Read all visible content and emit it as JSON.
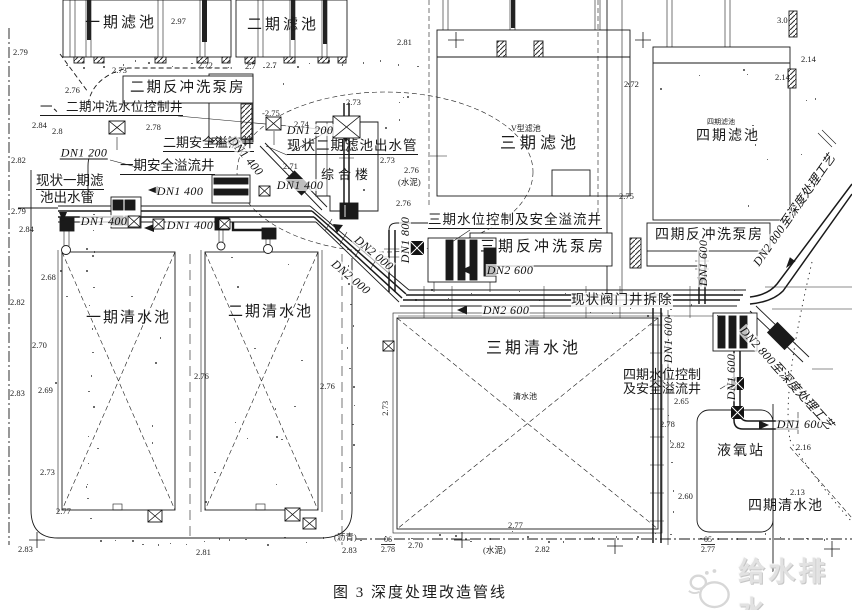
{
  "title_caption": "图 3  深度处理改造管线",
  "watermark_text": "给水排水",
  "structures": {
    "filter1": "一期滤池",
    "filter2": "二期滤池",
    "filter3": "三期滤池",
    "filter3_sub": "V型滤池",
    "filter4": "四期滤池",
    "filter4_sub": "四期滤池",
    "bwph2": "二期反冲洗泵房",
    "bwph3": "三期反冲洗泵房",
    "bwph4": "四期反冲洗泵房",
    "complex": "综合楼",
    "cw1": "一期清水池",
    "cw2": "二期清水池",
    "cw3": "三期清水池",
    "cw3_sub": "清水池",
    "cw4": "四期清水池",
    "lox": "液氧站"
  },
  "callouts": {
    "well12": "一、二期冲洗水位控制井",
    "overflow2": "二期安全溢流井",
    "overflow1": "一期安全溢流井",
    "outlet1_l1": "现状一期滤",
    "outlet1_l2": "池出水管",
    "outlet2": "现状二期滤池出水管",
    "ctrl3": "三期水位控制及安全溢流井",
    "valve_demolish": "现状阀门井拆除",
    "ctrl4_l1": "四期水位控制",
    "ctrl4_l2": "及安全溢流井"
  },
  "pipe_labels": [
    {
      "t": "DN1 200",
      "x": 84,
      "y": 153,
      "r": 0,
      "u": 1
    },
    {
      "t": "DN1 200",
      "x": 310,
      "y": 130,
      "r": 0
    },
    {
      "t": "DN1 400",
      "x": 180,
      "y": 191,
      "r": 0
    },
    {
      "t": "DN1 400",
      "x": 300,
      "y": 185,
      "r": 0
    },
    {
      "t": "DN1 400",
      "x": 104,
      "y": 221,
      "r": 0
    },
    {
      "t": "DN1 400",
      "x": 190,
      "y": 225,
      "r": 0
    },
    {
      "t": "DN1 400",
      "x": 246,
      "y": 156,
      "r": 50
    },
    {
      "t": "DN1 800",
      "x": 405,
      "y": 240,
      "r": -90
    },
    {
      "t": "DN2 000",
      "x": 374,
      "y": 253,
      "r": 40
    },
    {
      "t": "DN2 000",
      "x": 351,
      "y": 277,
      "r": 40
    },
    {
      "t": "DN2 600",
      "x": 510,
      "y": 270,
      "r": 0
    },
    {
      "t": "DN2 600",
      "x": 506,
      "y": 310,
      "r": 0
    },
    {
      "t": "DN1 600",
      "x": 703,
      "y": 263,
      "r": -90
    },
    {
      "t": "DN1 600",
      "x": 668,
      "y": 340,
      "r": -90
    },
    {
      "t": "DN1 600",
      "x": 731,
      "y": 377,
      "r": -90
    },
    {
      "t": "DN1 600",
      "x": 800,
      "y": 424,
      "r": 0
    },
    {
      "t": "DN2 800至深度处理工艺",
      "x": 794,
      "y": 210,
      "r": -55
    },
    {
      "t": "DN2 800至深度处理工艺",
      "x": 787,
      "y": 378,
      "r": 48
    }
  ],
  "spot_elevations": [
    {
      "x": 13,
      "y": 48,
      "v": "2.79"
    },
    {
      "x": 171,
      "y": 17,
      "v": "2.97"
    },
    {
      "x": 112,
      "y": 66,
      "v": "2.73"
    },
    {
      "x": 198,
      "y": 61,
      "v": "2.72"
    },
    {
      "x": 245,
      "y": 62,
      "v": "2.7"
    },
    {
      "x": 266,
      "y": 61,
      "v": "2.7"
    },
    {
      "x": 65,
      "y": 86,
      "v": "2.76"
    },
    {
      "x": 262,
      "y": 109,
      "v": "-2.75"
    },
    {
      "x": 146,
      "y": 123,
      "v": "2.78"
    },
    {
      "x": 52,
      "y": 127,
      "v": "2.8"
    },
    {
      "x": 32,
      "y": 121,
      "v": "2.84"
    },
    {
      "x": 294,
      "y": 120,
      "v": "2.74"
    },
    {
      "x": 11,
      "y": 156,
      "v": "2.82"
    },
    {
      "x": 283,
      "y": 162,
      "v": "2.71"
    },
    {
      "x": 346,
      "y": 98,
      "v": "2.73"
    },
    {
      "x": 380,
      "y": 156,
      "v": "2.73"
    },
    {
      "x": 404,
      "y": 166,
      "v": "2.76"
    },
    {
      "x": 396,
      "y": 199,
      "v": "2.76"
    },
    {
      "x": 11,
      "y": 207,
      "v": "2.79"
    },
    {
      "x": 19,
      "y": 225,
      "v": "2.84"
    },
    {
      "x": 41,
      "y": 273,
      "v": "2.68"
    },
    {
      "x": 10,
      "y": 298,
      "v": "2.82"
    },
    {
      "x": 32,
      "y": 341,
      "v": "2.70"
    },
    {
      "x": 10,
      "y": 389,
      "v": "2.83"
    },
    {
      "x": 38,
      "y": 386,
      "v": "2.69"
    },
    {
      "x": 194,
      "y": 372,
      "v": "2.76"
    },
    {
      "x": 320,
      "y": 382,
      "v": "2.76"
    },
    {
      "x": 378,
      "y": 404,
      "v": "2.73",
      "r": -90
    },
    {
      "x": 40,
      "y": 468,
      "v": "2.73"
    },
    {
      "x": 56,
      "y": 507,
      "v": "2.77"
    },
    {
      "x": 18,
      "y": 545,
      "v": "2.83"
    },
    {
      "x": 196,
      "y": 548,
      "v": "2.81"
    },
    {
      "x": 342,
      "y": 546,
      "v": "2.83"
    },
    {
      "x": 408,
      "y": 541,
      "v": "2.70"
    },
    {
      "x": 535,
      "y": 545,
      "v": "2.82"
    },
    {
      "x": 508,
      "y": 521,
      "v": "2.77"
    },
    {
      "x": 624,
      "y": 80,
      "v": "2.72"
    },
    {
      "x": 777,
      "y": 16,
      "v": "3.0"
    },
    {
      "x": 801,
      "y": 55,
      "v": "2.14"
    },
    {
      "x": 775,
      "y": 73,
      "v": "2.14"
    },
    {
      "x": 619,
      "y": 192,
      "v": "2.75"
    },
    {
      "x": 674,
      "y": 397,
      "v": "2.65"
    },
    {
      "x": 660,
      "y": 420,
      "v": "2.78"
    },
    {
      "x": 670,
      "y": 441,
      "v": "2.82"
    },
    {
      "x": 796,
      "y": 443,
      "v": "2.16"
    },
    {
      "x": 678,
      "y": 492,
      "v": "2.60"
    },
    {
      "x": 790,
      "y": 488,
      "v": "2.13"
    },
    {
      "x": 397,
      "y": 38,
      "v": "2.81"
    }
  ],
  "surface_notes": [
    {
      "x": 398,
      "y": 178,
      "t": "(水泥)"
    },
    {
      "x": 483,
      "y": 546,
      "t": "(水泥)"
    },
    {
      "x": 334,
      "y": 533,
      "t": "(沥青)"
    }
  ],
  "fractions": [
    {
      "x": 381,
      "y": 535,
      "a": "06",
      "b": "2.78"
    },
    {
      "x": 701,
      "y": 535,
      "a": "05",
      "b": "2.77"
    }
  ]
}
